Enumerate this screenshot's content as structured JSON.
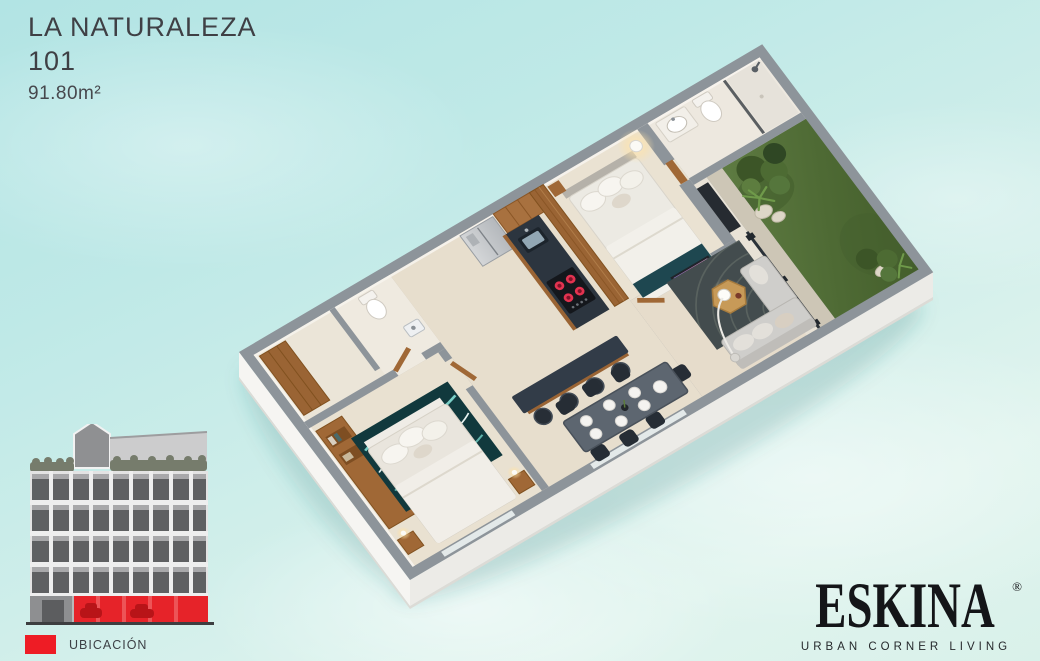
{
  "unit": {
    "project_name": "LA NATURALEZA",
    "unit_number": "101",
    "area": "91.80m²"
  },
  "legend": {
    "label": "UBICACIÓN",
    "swatch_color": "#ee1c25"
  },
  "brand": {
    "wordmark": "ESKINA",
    "registered_mark": "®",
    "tagline": "URBAN CORNER LIVING"
  },
  "illustration": {
    "type": "isometric-floor-plan",
    "rooms": [
      "master-bedroom",
      "bathroom",
      "shower",
      "garden-patio",
      "living-room",
      "dining-area",
      "kitchen",
      "hallway",
      "powder-room",
      "second-bedroom"
    ],
    "palette": {
      "water_background": "#c5ebe7",
      "wall_cap_gray": "#8d949a",
      "floor_cream": "#e8dfcf",
      "wood": "#9a6434",
      "grass_green": "#55703c",
      "counter_dark": "#2c353f",
      "sofa_gray": "#cfcecb",
      "rug_teal": "#11393d",
      "accent_red": "#ee1c25"
    }
  },
  "building": {
    "floors_of_windows": 4,
    "highlight": "ground-floor-red"
  }
}
